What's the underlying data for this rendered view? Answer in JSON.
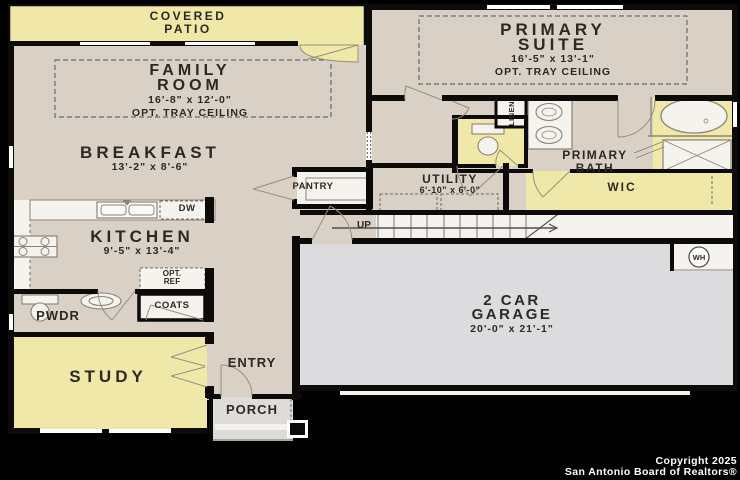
{
  "plan": {
    "rooms": {
      "covered_patio": {
        "line1": "COVERED",
        "line2": "PATIO"
      },
      "family_room": {
        "line1": "FAMILY",
        "line2": "ROOM",
        "dims": "16'-8\" x 12'-0\"",
        "option": "OPT. TRAY CEILING"
      },
      "breakfast": {
        "name": "BREAKFAST",
        "dims": "13'-2\" x 8'-6\""
      },
      "kitchen": {
        "name": "KITCHEN",
        "dims": "9'-5\" x 13'-4\""
      },
      "pantry": {
        "name": "PANTRY"
      },
      "opt_ref": {
        "line1": "OPT.",
        "line2": "REF"
      },
      "coats": {
        "name": "COATS"
      },
      "pwdr": {
        "name": "PWDR"
      },
      "study": {
        "name": "STUDY"
      },
      "entry": {
        "name": "ENTRY"
      },
      "porch": {
        "name": "PORCH"
      },
      "primary_suite": {
        "line1": "PRIMARY",
        "line2": "SUITE",
        "dims": "16'-5\" x 13'-1\"",
        "option": "OPT. TRAY CEILING"
      },
      "linen": {
        "name": "LINEN"
      },
      "primary_bath": {
        "line1": "PRIMARY",
        "line2": "BATH"
      },
      "wic": {
        "name": "WIC"
      },
      "utility": {
        "name": "UTILITY",
        "dims": "6'-10\" x 6'-0\""
      },
      "garage": {
        "line1": "2 CAR",
        "line2": "GARAGE",
        "dims": "20'-0\" x 21'-1\""
      },
      "stairs": {
        "label": "UP"
      },
      "appliances": {
        "dishwasher": "DW",
        "water_heater": "WH"
      }
    },
    "footer": {
      "line1": "Copyright 2025",
      "line2": "San Antonio Board of Realtors®"
    },
    "colors": {
      "background": "#000000",
      "wall": "#0c0b09",
      "floor_tan": "#d9d0c6",
      "floor_yellow": "#f0e8a8",
      "garage_gray": "#dcdbdd",
      "porch_gray": "#dddcd8",
      "fixture_white": "#f5f3ee",
      "fixture_line": "#8a8378",
      "text": "#2c2823",
      "footer_text": "#ffffff"
    }
  }
}
